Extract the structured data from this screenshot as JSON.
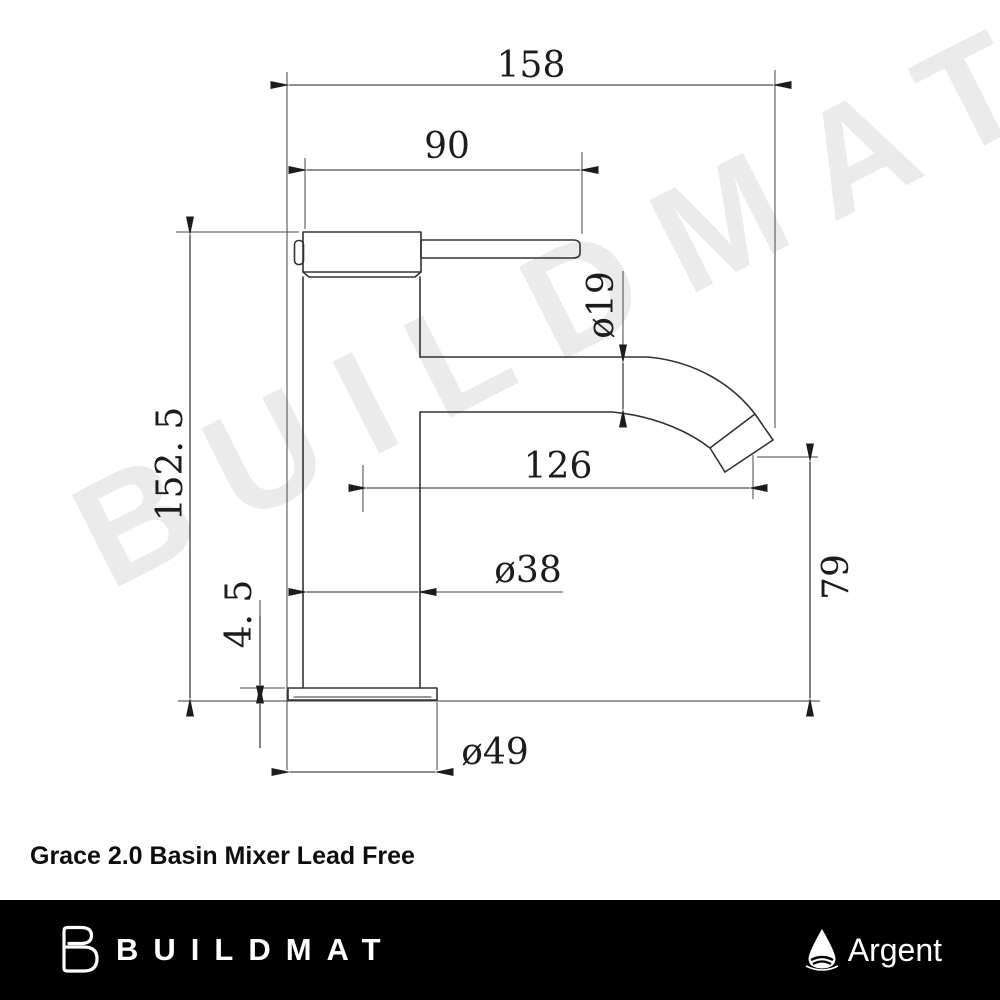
{
  "watermark": {
    "text": "BUILDMAT"
  },
  "title": "Grace 2.0 Basin Mixer Lead Free",
  "drawing": {
    "type": "technical-dimension-drawing",
    "subject": "basin mixer tap side elevation",
    "units": "mm",
    "dimensions": {
      "total_projection": "158",
      "handle_length": "90",
      "spout_tube_diameter": "ø19",
      "spout_reach": "126",
      "body_diameter": "ø38",
      "base_plate_height": "4. 5",
      "outlet_height": "79",
      "base_diameter": "ø49",
      "total_height": "152. 5"
    }
  },
  "footer": {
    "brand": "BUILDMAT",
    "partner": "Argent"
  }
}
